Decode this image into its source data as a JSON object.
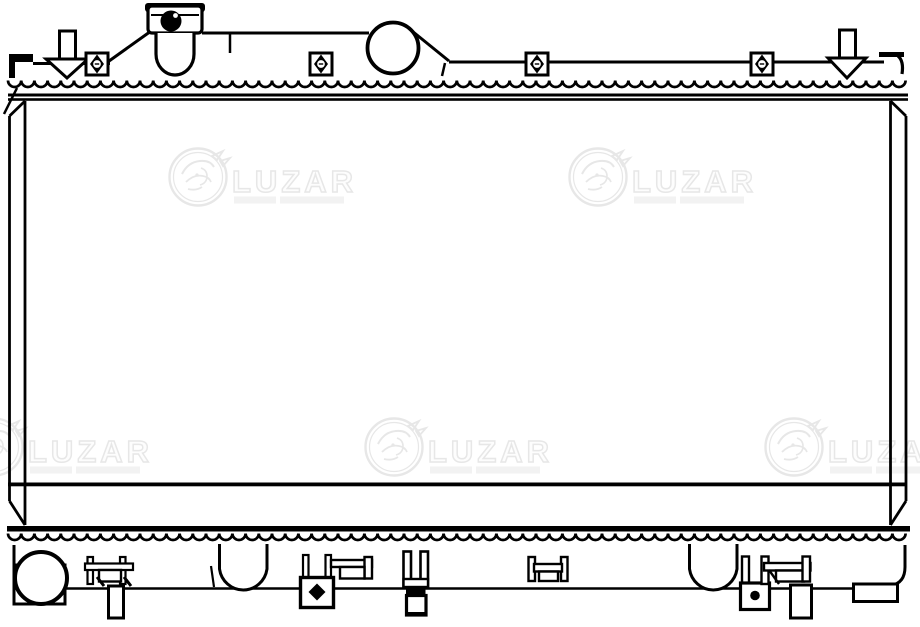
{
  "canvas": {
    "width": 920,
    "height": 627,
    "background": "#ffffff",
    "line_color": "#000000"
  },
  "watermark": {
    "brand": "LUZAR",
    "color": "#e7e7e7",
    "instances": [
      {
        "x": 168,
        "y": 148
      },
      {
        "x": 568,
        "y": 148
      },
      {
        "x": -36,
        "y": 418
      },
      {
        "x": 364,
        "y": 418
      },
      {
        "x": 764,
        "y": 418
      }
    ]
  }
}
